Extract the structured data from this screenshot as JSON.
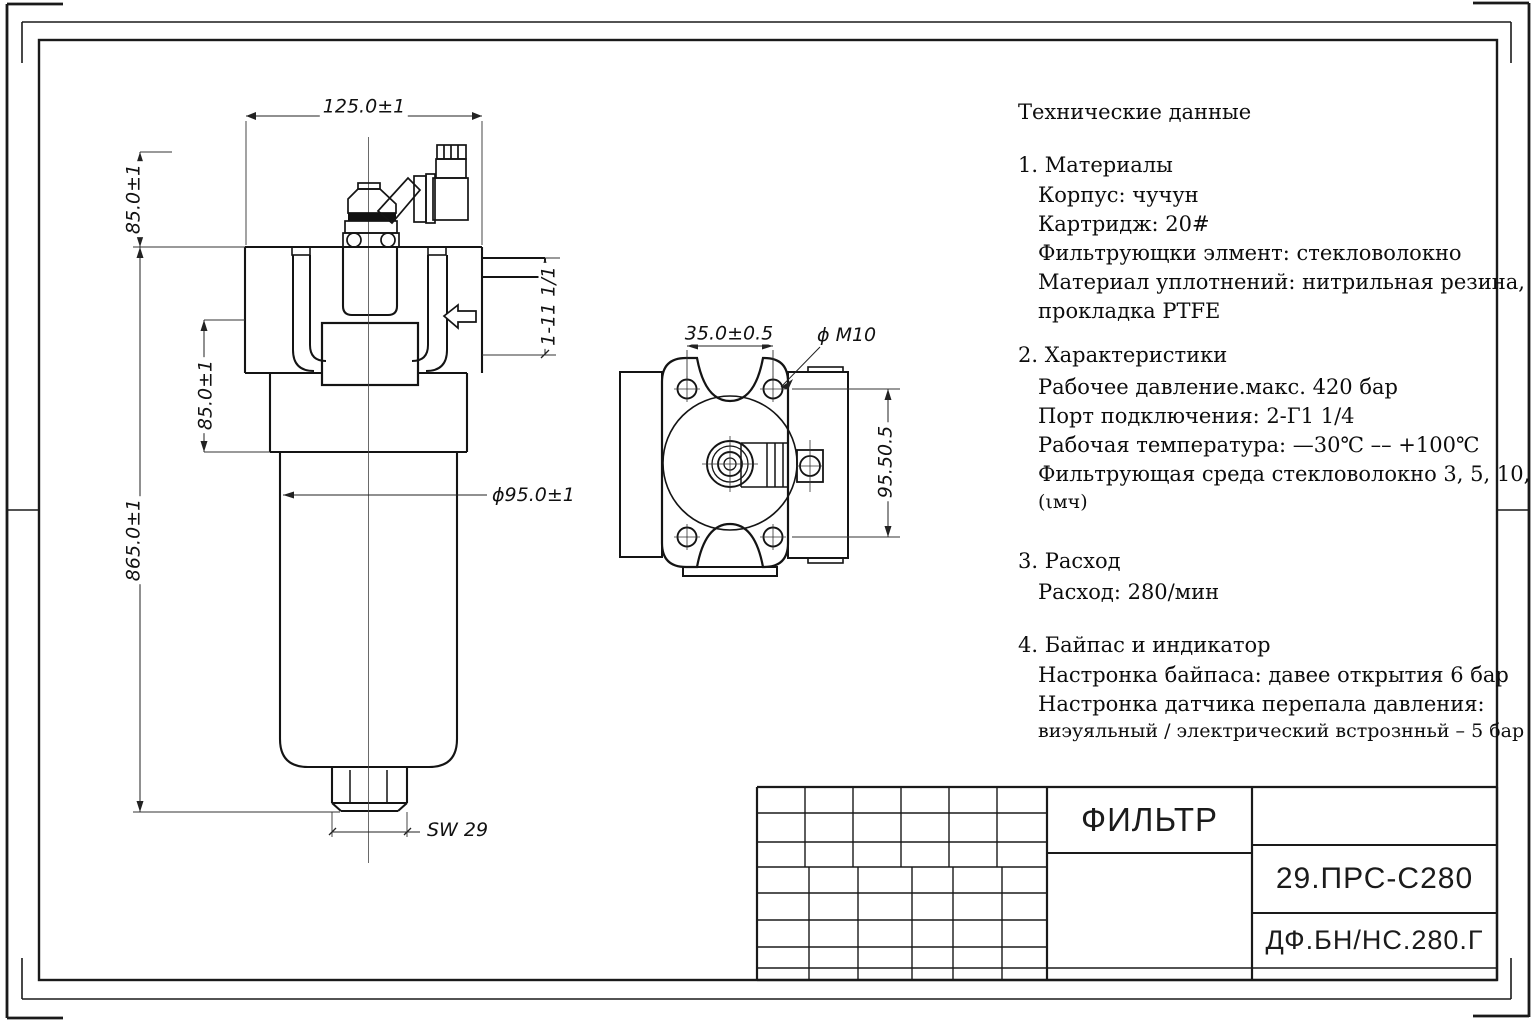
{
  "tech_data": {
    "title": "Технические данные",
    "sections": [
      {
        "heading": "1. Материалы",
        "lines": [
          "Корпус: чучун",
          "Картридж: 20#",
          "Фильтрующки элмент: стекловолокно",
          "Материал уплотнений: нитрильная резина,",
          "прокладка PTFE"
        ]
      },
      {
        "heading": "2.  Характеристики",
        "lines": [
          "Рабочее давление.макс. 420 бар",
          "Порт подключения: 2-Г1 1/4",
          "Рабочая температура: —30℃ ––  +100℃",
          "Фильтрующая среда стекловолокно 3, 5, 10, 20",
          "(ιмч)"
        ]
      },
      {
        "heading": "3.  Расход",
        "lines": [
          "Расход: 280/мин"
        ]
      },
      {
        "heading": "4.  Байпас и индикатор",
        "lines": [
          "Настронка байпаса: давее открытия 6 бар",
          "Настронка датчика перепала давления:",
          "виэуяльный / электрический встрознньй – 5 бар"
        ]
      }
    ]
  },
  "side_view": {
    "dim_width": "125.0±1",
    "dim_height_top": "85.0±1",
    "dim_height_mid": "85.0±1",
    "dim_height_total": "865.0±1",
    "dim_bowl_diameter": "ϕ95.0±1",
    "dim_wrench": "SW 29",
    "dim_port_thread": "1-11 1/1"
  },
  "top_view": {
    "dim_hole_spacing": "35.0±0.5",
    "dim_thread": "ϕ M10",
    "dim_vertical": "95.50.5"
  },
  "title_block": {
    "part_name": "ФИЛЬТР",
    "model_code": "29.ПРС-С280",
    "doc_number": "ДФ.БН/НС.280.Г"
  }
}
